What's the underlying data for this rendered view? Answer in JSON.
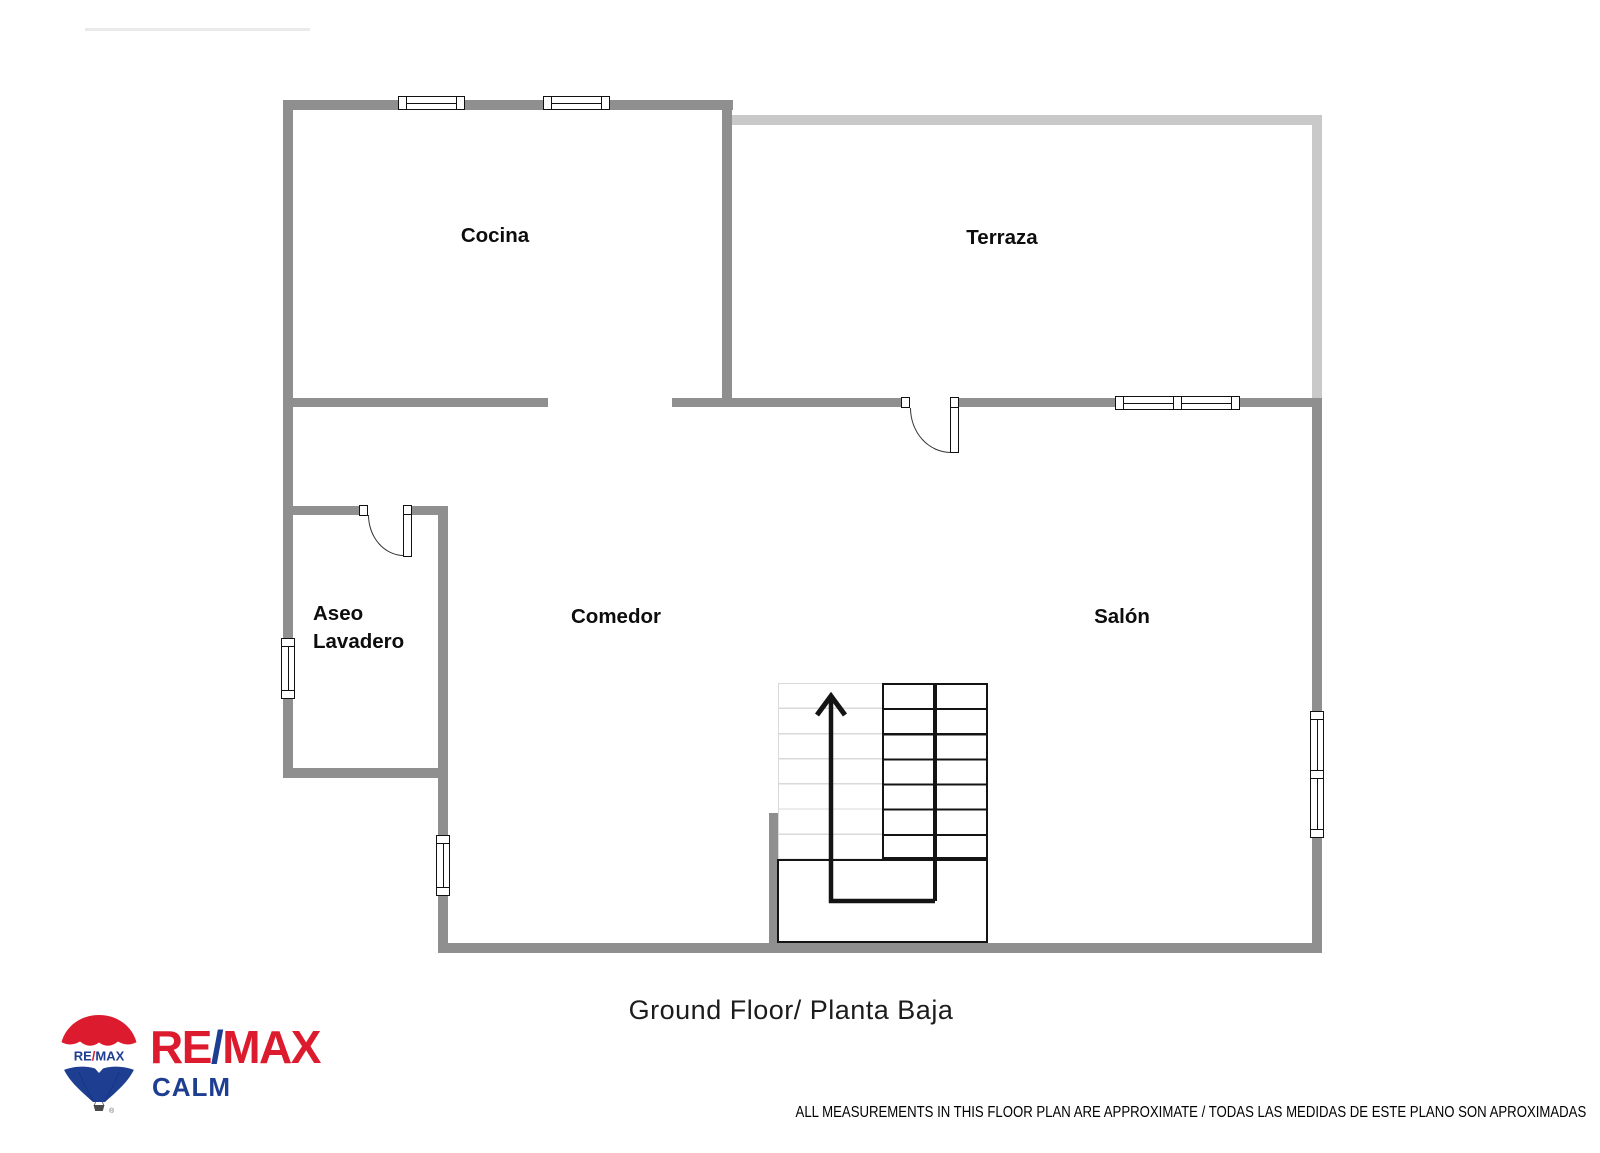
{
  "rooms": {
    "cocina": {
      "label": "Cocina"
    },
    "terraza": {
      "label": "Terraza"
    },
    "aseo_lavadero": {
      "line1": "Aseo",
      "line2": "Lavadero"
    },
    "comedor": {
      "label": "Comedor"
    },
    "salon": {
      "label": "Salón"
    }
  },
  "footer": {
    "floor_title": "Ground Floor/ Planta Baja",
    "disclaimer": "ALL MEASUREMENTS IN THIS FLOOR PLAN ARE APPROXIMATE / TODAS LAS MEDIDAS DE ESTE PLANO SON APROXIMADAS"
  },
  "logo": {
    "balloon": {
      "re": "RE",
      "slash": "/",
      "max": "MAX"
    },
    "wordmark": {
      "re": "RE",
      "slash": "/",
      "max": "MAX"
    },
    "subbrand": "CALM",
    "registered": "®",
    "colors": {
      "red": "#DC1C2E",
      "blue": "#1D3E91"
    }
  },
  "plan_colors": {
    "wall": "#8F8F8F",
    "wall_light": "#C9C9C9",
    "stair_tread_light": "#D9D9D9",
    "outline": "#141414"
  }
}
